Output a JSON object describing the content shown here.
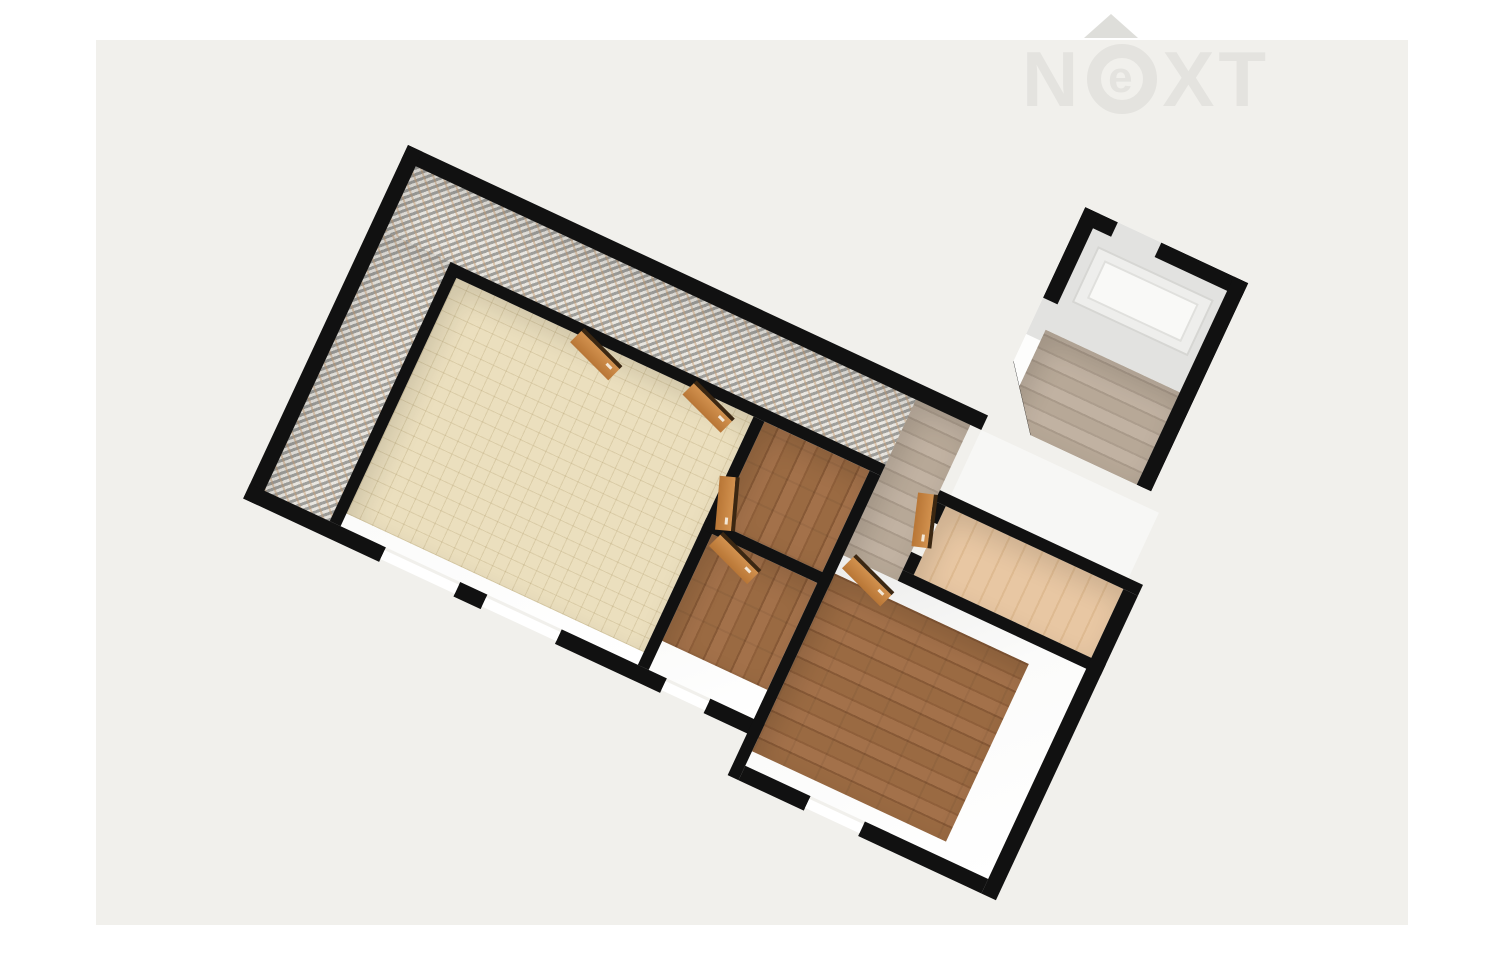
{
  "watermark": {
    "brand": "NeXT",
    "letter_n": "N",
    "letter_e": "e",
    "letter_x": "X",
    "letter_t": "T",
    "roof_icon": "triangle-up",
    "color": "#e4e3df"
  },
  "palette": {
    "page_bg": "#ffffff",
    "panel_bg": "#f1f0ec",
    "wall": "#111111",
    "door": "#c8823f",
    "door_edge": "#3b2712",
    "tile_cream": "#ebdfbe",
    "mosaic_gray": "#a7a49c",
    "mosaic_white": "#edeae4",
    "mosaic_tan": "#c79d72",
    "wood_brown": "#9a6a42",
    "wood_light": "#b5a695",
    "wood_peach": "#e7c6a2",
    "interior_white": "#fafafa",
    "stair_landing": "#f4f4f2"
  },
  "floorplan": {
    "type": "3d-floor-plan-render",
    "rotation_deg": 25,
    "rooms": [
      {
        "id": "corridor-l",
        "floor": "mosaic-tile"
      },
      {
        "id": "living-room",
        "floor": "cream-tile"
      },
      {
        "id": "bedroom-small",
        "floor": "brown-wood"
      },
      {
        "id": "bedroom-middle",
        "floor": "brown-wood"
      },
      {
        "id": "bedroom-large",
        "floor": "brown-wood"
      },
      {
        "id": "hallway",
        "floor": "light-wood"
      },
      {
        "id": "closet",
        "floor": "peach-wood"
      },
      {
        "id": "stair-hall",
        "floor": "light-wood",
        "feature": "stair-landing"
      }
    ],
    "door_count": 6,
    "window_count": 4
  }
}
